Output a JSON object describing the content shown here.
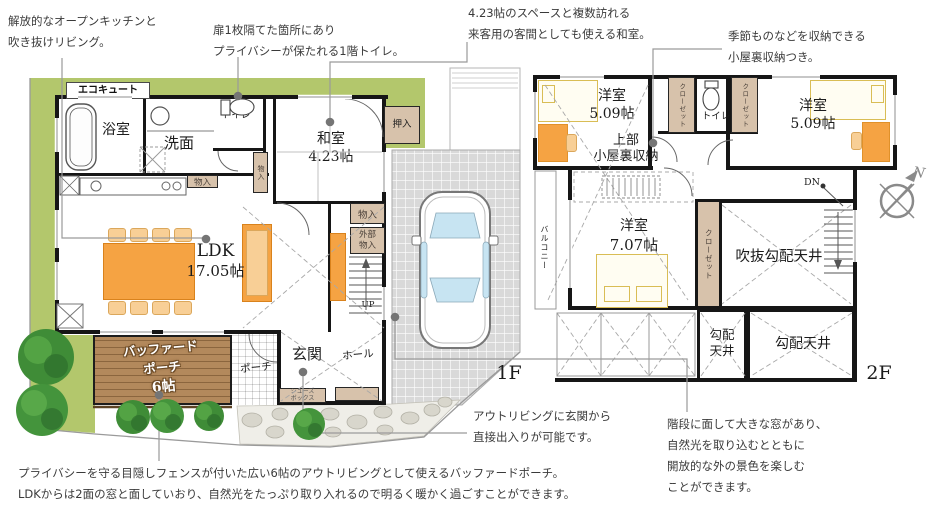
{
  "colors": {
    "yard_green": "#b3c76c",
    "deck_brown": "#b3895c",
    "storage_beige": "#d7c2ab",
    "furniture_orange": "#f5a343",
    "bed_yellow": "#d9bd55",
    "driveway_gray": "#d9d9d9",
    "wall_black": "#161616",
    "car_glass_blue": "#c7e4f2",
    "leader_gray": "#9a9a9a"
  },
  "compass": {
    "label": "N"
  },
  "floor_tags": {
    "f1": "1F",
    "f2": "2F"
  },
  "annotations": {
    "kitchen": {
      "lines": [
        "解放的なオープンキッチンと",
        "吹き抜けリビング。"
      ]
    },
    "toilet1f": {
      "lines": [
        "扉1枚隔てた箇所にあり",
        "プライバシーが保たれる1階トイレ。"
      ]
    },
    "washitsu": {
      "lines": [
        "4.23帖のスペースと複数訪れる",
        "来客用の客間としても使える和室。"
      ]
    },
    "attic": {
      "lines": [
        "季節ものなどを収納できる",
        "小屋裏収納つき。"
      ]
    },
    "outliving": {
      "lines": [
        "アウトリビングに玄関から",
        "直接出入りが可能です。"
      ]
    },
    "porch": {
      "lines": [
        "プライバシーを守る目隠しフェンスが付いた広い6帖のアウトリビングとして使えるバッファードポーチ。",
        "LDKからは2面の窓と面していおり、自然光をたっぷり取り入れるので明るく暖かく過ごすことができます。"
      ]
    },
    "stairs": {
      "lines": [
        "階段に面して大きな窓があり、",
        "自然光を取り込むとともに",
        "開放的な外の景色を楽しむ",
        "ことができます。"
      ]
    }
  },
  "floor1": {
    "eco": "エコキュート",
    "bath": "浴室",
    "wash": "洗面",
    "toilet": "トイレ",
    "washitsu": {
      "name": "和室",
      "size": "4.23帖"
    },
    "oshiire": "押入",
    "storage": "物入",
    "storage_ext": [
      "外部",
      "物入"
    ],
    "ldk": {
      "name": "LDK",
      "size": "17.05帖"
    },
    "up": "UP",
    "deck": {
      "l1": "バッファード",
      "l2": "ポーチ",
      "l3": "6帖"
    },
    "porch": "ポーチ",
    "genkan": "玄関",
    "hall": "ホール",
    "shoes": [
      "シューズ",
      "ボックス"
    ]
  },
  "floor2": {
    "room_small": {
      "name": "洋室",
      "size": "5.09帖"
    },
    "room_main": {
      "name": "洋室",
      "size": "7.07帖"
    },
    "attic": [
      "上部",
      "小屋裏収納"
    ],
    "closet": "クローゼット",
    "toilet": "トイレ",
    "balcony": "バルコニー",
    "void_ceiling": "吹抜勾配天井",
    "sloped_ceiling": "勾配天井",
    "sloped_ceiling_2l": [
      "勾配",
      "天井"
    ],
    "dn": "DN"
  }
}
